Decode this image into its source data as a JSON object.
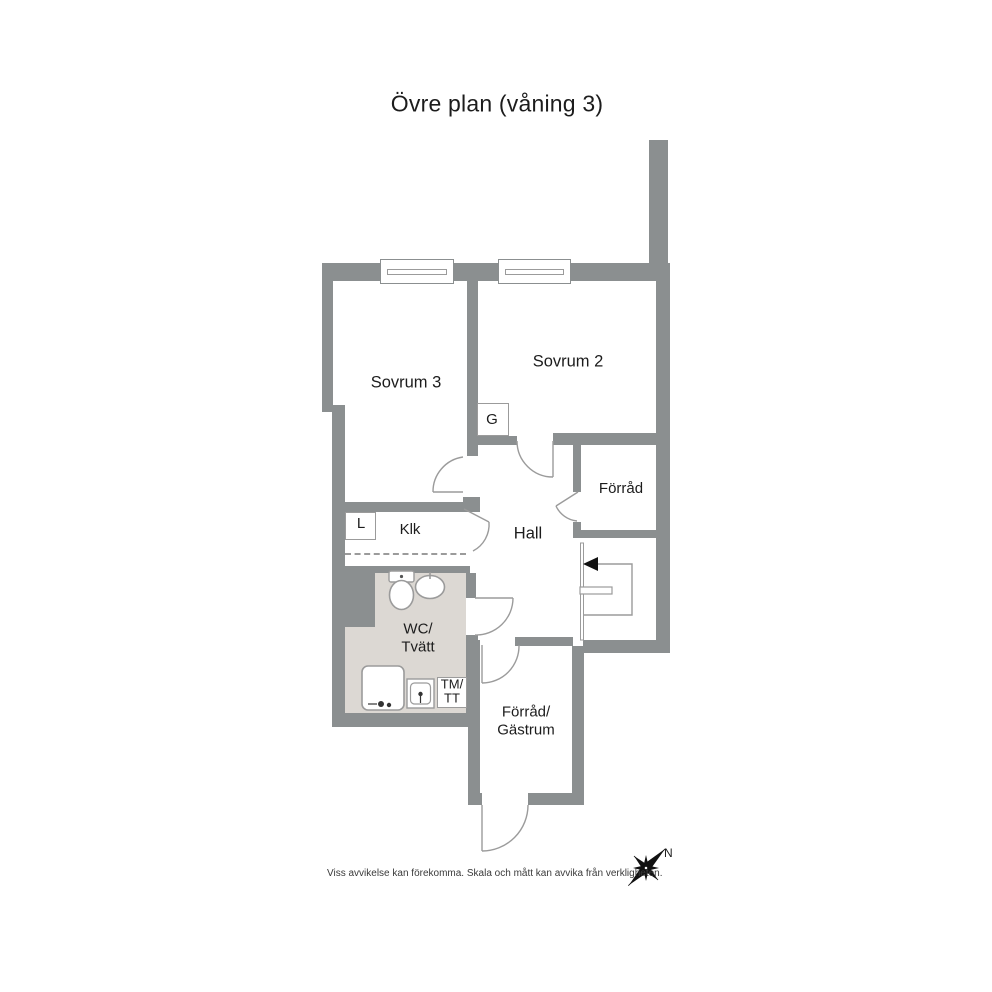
{
  "title": "Övre plan (våning 3)",
  "disclaimer": "Viss avvikelse kan förekomma. Skala och mått kan avvika från verkligheten.",
  "compass": {
    "north_label": "N"
  },
  "rooms": {
    "sovrum3": "Sovrum 3",
    "sovrum2": "Sovrum 2",
    "forrad": "Förråd",
    "hall": "Hall",
    "klk": "Klk",
    "closet_g": "G",
    "closet_l": "L",
    "wc_line1": "WC/",
    "wc_line2": "Tvätt",
    "tm_line1": "TM/",
    "tm_line2": "TT",
    "forrad_gastrum_line1": "Förråd/",
    "forrad_gastrum_line2": "Gästrum"
  },
  "colors": {
    "wall": "#8b8f90",
    "wet_room_floor": "#dcd8d3",
    "thin_line": "#9b9b9b",
    "text": "#1c1c1c"
  }
}
